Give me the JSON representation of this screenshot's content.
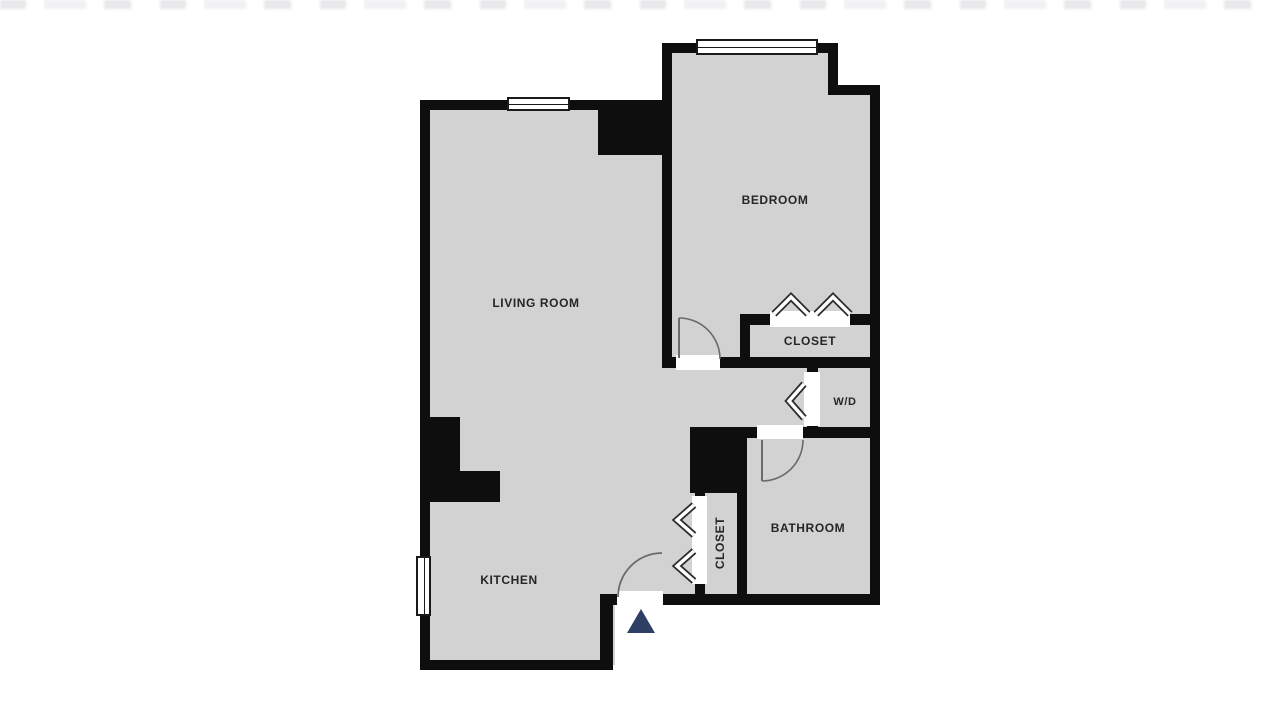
{
  "floorplan": {
    "rooms": [
      {
        "id": "living-room",
        "label": "LIVING ROOM"
      },
      {
        "id": "bedroom",
        "label": "BEDROOM"
      },
      {
        "id": "kitchen",
        "label": "KITCHEN"
      },
      {
        "id": "bathroom",
        "label": "BATHROOM"
      },
      {
        "id": "bedroom-closet",
        "label": "CLOSET"
      },
      {
        "id": "hall-closet",
        "label": "CLOSET"
      },
      {
        "id": "laundry",
        "label": "W/D"
      }
    ],
    "colors": {
      "wall": "#0e0e0e",
      "floor": "#d2d2d2",
      "entrance_marker": "#2e3f66",
      "label_text": "#262626",
      "door_arc": "#6a6a6a"
    }
  }
}
